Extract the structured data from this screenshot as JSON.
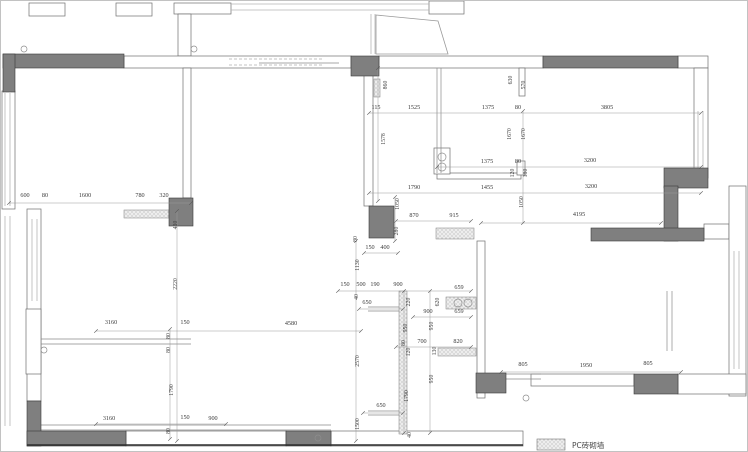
{
  "legend": {
    "label": "PC砖砌墙"
  },
  "colors": {
    "wall_fill": "#7f7f7f",
    "wall_stroke": "#3a3a3a",
    "white_wall_stroke": "#6e6e6e",
    "window": "#b5b5b5",
    "detail": "#8a8a8a",
    "dim_line": "#9a9a9a",
    "dim_text": "#3c3c3c",
    "hatch_bg": "#ededed",
    "hatch_dot": "#8f8f8f"
  },
  "plan": {
    "white_walls": [
      [
        28,
        2,
        36,
        13
      ],
      [
        115,
        2,
        36,
        13
      ],
      [
        173,
        2,
        57,
        11
      ],
      [
        428,
        0,
        35,
        13
      ],
      [
        177,
        13,
        13,
        42
      ],
      [
        123,
        55,
        227,
        12
      ],
      [
        378,
        55,
        164,
        12
      ],
      [
        677,
        55,
        30,
        12
      ],
      [
        693,
        67,
        14,
        110
      ],
      [
        1,
        90,
        13,
        118
      ],
      [
        26,
        208,
        14,
        192
      ],
      [
        25,
        308,
        15,
        65
      ],
      [
        182,
        67,
        8,
        130
      ],
      [
        363,
        67,
        9,
        138
      ],
      [
        436,
        172,
        84,
        6
      ],
      [
        518,
        67,
        6,
        28
      ],
      [
        516,
        160,
        8,
        14
      ],
      [
        433,
        147,
        16,
        26
      ],
      [
        476,
        240,
        8,
        157
      ],
      [
        703,
        223,
        25,
        15
      ],
      [
        728,
        185,
        17,
        210
      ],
      [
        530,
        373,
        103,
        12
      ],
      [
        677,
        373,
        68,
        20
      ],
      [
        125,
        430,
        160,
        15
      ],
      [
        330,
        430,
        192,
        15
      ]
    ],
    "solid_walls": [
      [
        2,
        53,
        121,
        14
      ],
      [
        2,
        53,
        12,
        38
      ],
      [
        350,
        55,
        28,
        20
      ],
      [
        542,
        55,
        135,
        12
      ],
      [
        663,
        167,
        44,
        20
      ],
      [
        663,
        185,
        14,
        55
      ],
      [
        590,
        227,
        113,
        13
      ],
      [
        168,
        197,
        24,
        28
      ],
      [
        368,
        205,
        25,
        32
      ],
      [
        475,
        372,
        30,
        20
      ],
      [
        633,
        373,
        44,
        20
      ],
      [
        26,
        400,
        14,
        45
      ],
      [
        26,
        430,
        99,
        15
      ],
      [
        285,
        430,
        45,
        15
      ]
    ],
    "hatch_rects": [
      [
        123,
        209,
        45,
        8
      ],
      [
        373,
        78,
        6,
        18
      ],
      [
        435,
        227,
        38,
        11
      ],
      [
        445,
        296,
        30,
        12
      ],
      [
        437,
        347,
        38,
        8
      ],
      [
        398,
        290,
        8,
        143
      ]
    ],
    "window_lines": [
      [
        230,
        3,
        428,
        3
      ],
      [
        230,
        9,
        428,
        9
      ],
      [
        370,
        13,
        370,
        53
      ],
      [
        374,
        13,
        374,
        53
      ],
      [
        4,
        92,
        4,
        205
      ],
      [
        9,
        92,
        9,
        205
      ],
      [
        4,
        215,
        4,
        425
      ],
      [
        9,
        215,
        9,
        425
      ],
      [
        31,
        218,
        31,
        300
      ],
      [
        36,
        218,
        36,
        300
      ],
      [
        697,
        110,
        697,
        168
      ],
      [
        702,
        110,
        702,
        168
      ],
      [
        733,
        250,
        733,
        368
      ],
      [
        738,
        250,
        738,
        368
      ]
    ],
    "lines": [
      [
        436,
        67,
        436,
        172
      ],
      [
        440,
        67,
        440,
        172
      ],
      [
        40,
        338,
        190,
        338
      ],
      [
        40,
        343,
        190,
        343
      ],
      [
        40,
        424,
        330,
        424
      ],
      [
        40,
        429,
        330,
        429
      ],
      [
        367,
        306,
        402,
        306
      ],
      [
        367,
        310,
        402,
        310
      ],
      [
        367,
        410,
        402,
        410
      ],
      [
        367,
        414,
        402,
        414
      ],
      [
        666,
        290,
        666,
        350
      ],
      [
        671,
        290,
        671,
        350
      ],
      [
        503,
        373,
        540,
        373
      ],
      [
        503,
        378,
        540,
        378
      ],
      [
        258,
        62,
        338,
        62
      ]
    ],
    "dashed_lines": [
      [
        228,
        58,
        323,
        58
      ],
      [
        228,
        64,
        323,
        64
      ]
    ],
    "thick_lines": [
      [
        26,
        444,
        522,
        444
      ]
    ],
    "polygons": [
      "375,14 437,20 447,53 375,53"
    ],
    "circles": [
      [
        23,
        48,
        3
      ],
      [
        193,
        48,
        3
      ],
      [
        441,
        156,
        4
      ],
      [
        441,
        166,
        4
      ],
      [
        457,
        302,
        4
      ],
      [
        467,
        302,
        4
      ],
      [
        525,
        397,
        3
      ],
      [
        317,
        437,
        3
      ],
      [
        43,
        349,
        3
      ]
    ],
    "dim_lines": [
      [
        8,
        202,
        190,
        202
      ],
      [
        176,
        210,
        176,
        440
      ],
      [
        377,
        67,
        377,
        200
      ],
      [
        368,
        112,
        700,
        112
      ],
      [
        436,
        166,
        700,
        166
      ],
      [
        368,
        192,
        700,
        192
      ],
      [
        395,
        220,
        470,
        220
      ],
      [
        480,
        222,
        660,
        222
      ],
      [
        363,
        252,
        397,
        252
      ],
      [
        522,
        110,
        522,
        222
      ],
      [
        394,
        196,
        394,
        240
      ],
      [
        337,
        290,
        470,
        290
      ],
      [
        412,
        316,
        470,
        316
      ],
      [
        95,
        330,
        360,
        330
      ],
      [
        358,
        308,
        402,
        308
      ],
      [
        395,
        346,
        470,
        346
      ],
      [
        362,
        412,
        402,
        412
      ],
      [
        95,
        423,
        225,
        423
      ],
      [
        500,
        371,
        680,
        371
      ],
      [
        355,
        240,
        355,
        440
      ],
      [
        403,
        290,
        403,
        432
      ],
      [
        429,
        290,
        429,
        432
      ],
      [
        169,
        328,
        169,
        438
      ]
    ],
    "labels_h": [
      {
        "x": 24,
        "y": 196,
        "t": "600"
      },
      {
        "x": 44,
        "y": 196,
        "t": "80"
      },
      {
        "x": 84,
        "y": 196,
        "t": "1600"
      },
      {
        "x": 139,
        "y": 196,
        "t": "780"
      },
      {
        "x": 163,
        "y": 196,
        "t": "320"
      },
      {
        "x": 375,
        "y": 108,
        "t": "115"
      },
      {
        "x": 413,
        "y": 108,
        "t": "1525"
      },
      {
        "x": 487,
        "y": 108,
        "t": "1375"
      },
      {
        "x": 517,
        "y": 108,
        "t": "80"
      },
      {
        "x": 606,
        "y": 108,
        "t": "3805"
      },
      {
        "x": 486,
        "y": 162,
        "t": "1375"
      },
      {
        "x": 517,
        "y": 162,
        "t": "80"
      },
      {
        "x": 589,
        "y": 161,
        "t": "3200"
      },
      {
        "x": 413,
        "y": 188,
        "t": "1790"
      },
      {
        "x": 486,
        "y": 188,
        "t": "1455"
      },
      {
        "x": 590,
        "y": 187,
        "t": "3200"
      },
      {
        "x": 578,
        "y": 215,
        "t": "4195"
      },
      {
        "x": 413,
        "y": 216,
        "t": "870"
      },
      {
        "x": 453,
        "y": 216,
        "t": "915"
      },
      {
        "x": 369,
        "y": 248,
        "t": "150"
      },
      {
        "x": 384,
        "y": 248,
        "t": "400"
      },
      {
        "x": 344,
        "y": 285,
        "t": "150"
      },
      {
        "x": 360,
        "y": 285,
        "t": "500"
      },
      {
        "x": 374,
        "y": 285,
        "t": "190"
      },
      {
        "x": 397,
        "y": 285,
        "t": "900"
      },
      {
        "x": 458,
        "y": 288,
        "t": "659"
      },
      {
        "x": 427,
        "y": 312,
        "t": "900"
      },
      {
        "x": 458,
        "y": 312,
        "t": "659"
      },
      {
        "x": 366,
        "y": 303,
        "t": "650"
      },
      {
        "x": 421,
        "y": 342,
        "t": "700"
      },
      {
        "x": 457,
        "y": 342,
        "t": "820"
      },
      {
        "x": 380,
        "y": 406,
        "t": "650"
      },
      {
        "x": 110,
        "y": 323,
        "t": "3160"
      },
      {
        "x": 184,
        "y": 323,
        "t": "150"
      },
      {
        "x": 290,
        "y": 324,
        "t": "4580"
      },
      {
        "x": 108,
        "y": 419,
        "t": "3160"
      },
      {
        "x": 184,
        "y": 418,
        "t": "150"
      },
      {
        "x": 212,
        "y": 419,
        "t": "900"
      },
      {
        "x": 522,
        "y": 365,
        "t": "805"
      },
      {
        "x": 585,
        "y": 366,
        "t": "1950"
      },
      {
        "x": 647,
        "y": 364,
        "t": "805"
      }
    ],
    "labels_v": [
      {
        "x": 176,
        "y": 224,
        "t": "430"
      },
      {
        "x": 176,
        "y": 283,
        "t": "2220"
      },
      {
        "x": 172,
        "y": 389,
        "t": "1790"
      },
      {
        "x": 386,
        "y": 84,
        "t": "860"
      },
      {
        "x": 384,
        "y": 138,
        "t": "1578"
      },
      {
        "x": 511,
        "y": 79,
        "t": "630"
      },
      {
        "x": 524,
        "y": 84,
        "t": "570"
      },
      {
        "x": 510,
        "y": 133,
        "t": "1670"
      },
      {
        "x": 524,
        "y": 133,
        "t": "1670"
      },
      {
        "x": 398,
        "y": 203,
        "t": "1050"
      },
      {
        "x": 522,
        "y": 201,
        "t": "1050"
      },
      {
        "x": 397,
        "y": 230,
        "t": "280"
      },
      {
        "x": 356,
        "y": 238,
        "t": "80"
      },
      {
        "x": 358,
        "y": 264,
        "t": "1130"
      },
      {
        "x": 357,
        "y": 296,
        "t": "40"
      },
      {
        "x": 358,
        "y": 360,
        "t": "2570"
      },
      {
        "x": 358,
        "y": 423,
        "t": "1500"
      },
      {
        "x": 409,
        "y": 301,
        "t": "220"
      },
      {
        "x": 438,
        "y": 301,
        "t": "620"
      },
      {
        "x": 406,
        "y": 327,
        "t": "950"
      },
      {
        "x": 432,
        "y": 325,
        "t": "950"
      },
      {
        "x": 404,
        "y": 342,
        "t": "80"
      },
      {
        "x": 409,
        "y": 351,
        "t": "120"
      },
      {
        "x": 435,
        "y": 350,
        "t": "130"
      },
      {
        "x": 432,
        "y": 378,
        "t": "950"
      },
      {
        "x": 407,
        "y": 395,
        "t": "1790"
      },
      {
        "x": 410,
        "y": 434,
        "t": "40"
      },
      {
        "x": 169,
        "y": 335,
        "t": "80"
      },
      {
        "x": 169,
        "y": 349,
        "t": "80"
      },
      {
        "x": 169,
        "y": 430,
        "t": "80"
      },
      {
        "x": 513,
        "y": 172,
        "t": "120"
      },
      {
        "x": 526,
        "y": 172,
        "t": "180"
      }
    ]
  }
}
